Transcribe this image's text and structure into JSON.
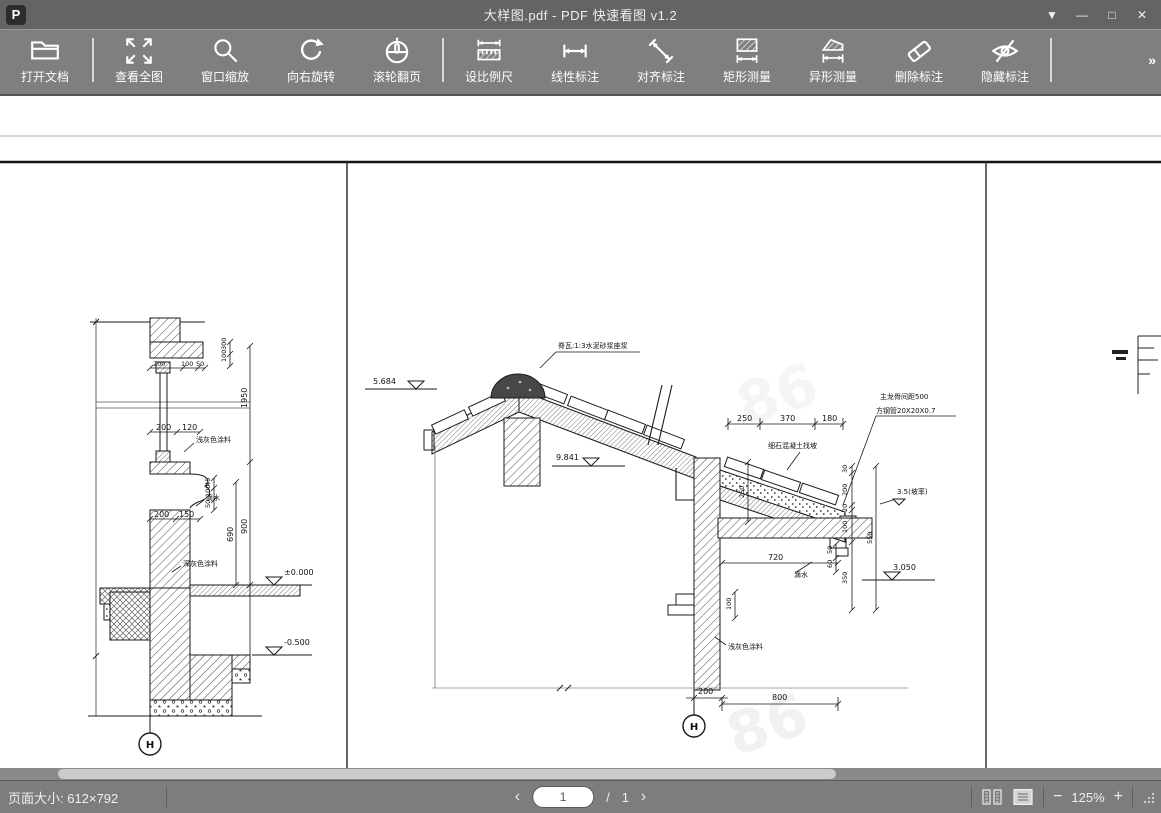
{
  "window": {
    "logo_letter": "P",
    "title": "大样图.pdf - PDF 快速看图 v1.2",
    "controls": {
      "menu": "▼",
      "minimize": "—",
      "maximize": "□",
      "close": "✕"
    }
  },
  "toolbar": {
    "overflow": "»",
    "buttons": [
      {
        "label": "打开文档"
      },
      {
        "label": "查看全图"
      },
      {
        "label": "窗口缩放"
      },
      {
        "label": "向右旋转"
      },
      {
        "label": "滚轮翻页"
      },
      {
        "label": "设比例尺"
      },
      {
        "label": "线性标注"
      },
      {
        "label": "对齐标注"
      },
      {
        "label": "矩形测量"
      },
      {
        "label": "异形测量"
      },
      {
        "label": "删除标注"
      },
      {
        "label": "隐藏标注"
      }
    ]
  },
  "statusbar": {
    "page_size": "页面大小: 612×792",
    "prev": "‹",
    "next": "›",
    "page_value": "1",
    "page_sep": "/",
    "page_total": "1",
    "zoom_out": "−",
    "zoom_level": "125%",
    "zoom_in": "+"
  },
  "drawing": {
    "left": {
      "top_dims": [
        "300",
        "100"
      ],
      "upper_dims": [
        "200",
        "100",
        "50"
      ],
      "mid_dims": [
        "200",
        "120"
      ],
      "molding_dims": [
        "45",
        "100",
        "50"
      ],
      "lower_dims": [
        "200",
        "150"
      ],
      "v_dims": [
        "1950",
        "900",
        "690"
      ],
      "elevations": [
        "±0.000",
        "-0.500"
      ],
      "labels": [
        "浅灰色涂料",
        "滴水",
        "深灰色涂料"
      ],
      "bubble": "H"
    },
    "center": {
      "elevations": [
        "5.684",
        "9.841",
        "3.050"
      ],
      "slope_note": "3.5(坡率)",
      "ridge_note": "脊瓦:1:3水泥砂浆座浆",
      "purlin_note1": "主龙骨间距500",
      "purlin_note2": "方钢管20X20X0.7",
      "fill_note": "细石混凝土找坡",
      "drip_note": "滴水",
      "paint_note": "浅灰色涂料",
      "top_dims": [
        "250",
        "370",
        "180"
      ],
      "right_dims": [
        "30",
        "200",
        "20",
        "100",
        "350",
        "550"
      ],
      "gutter_dim": "250",
      "slab_dim": "720",
      "small_dims": [
        "50",
        "60",
        "100"
      ],
      "bottom_dims": [
        "200",
        "800"
      ],
      "bubble": "H"
    },
    "watermark": "86"
  }
}
